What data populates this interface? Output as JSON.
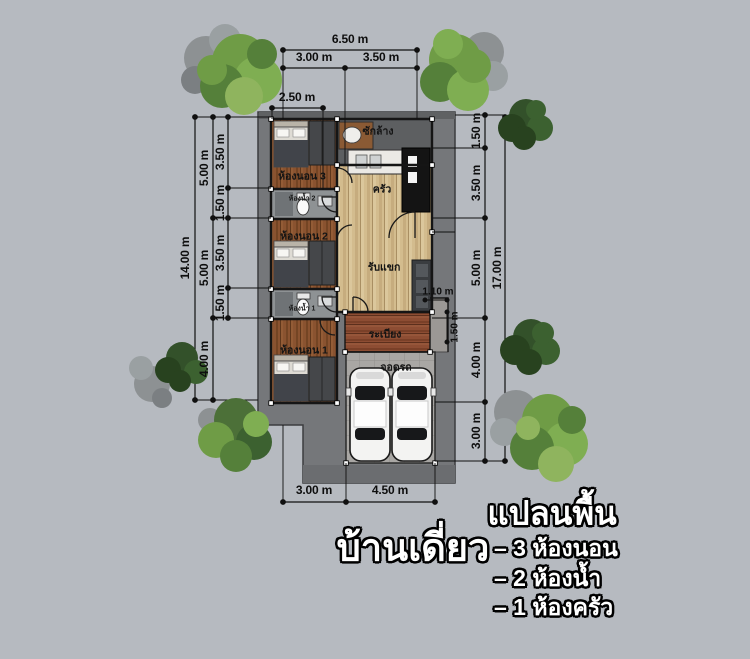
{
  "titles": {
    "plan_name": "บ้านเดี่ยว",
    "legend_heading": "แปลนพื้น",
    "legend_items": [
      "– 3 ห้องนอน",
      "– 2 ห้องน้ำ",
      "– 1 ห้องครัว"
    ]
  },
  "rooms": {
    "laundry": "ซักล้าง",
    "kitchen": "ครัว",
    "bedroom3": "ห้องนอน 3",
    "bath2": "ห้องน้ำ 2",
    "bedroom2": "ห้องนอน 2",
    "living": "รับแขก",
    "bath1": "ห้องน้ำ 1",
    "bedroom1": "ห้องนอน 1",
    "terrace": "ระเบียง",
    "carport": "จอดรถ"
  },
  "dimensions": {
    "top": {
      "total": "6.50 m",
      "left": "3.00 m",
      "right": "3.50 m",
      "inset": "2.50 m"
    },
    "left": {
      "total": "14.00 m",
      "mid": [
        "5.00 m",
        "5.00 m",
        "4.00 m"
      ],
      "inner": [
        "3.50 m",
        "1.50 m",
        "3.50 m",
        "1.50 m"
      ]
    },
    "right": {
      "total": "17.00 m",
      "inner": [
        "1.50 m",
        "3.50 m",
        "5.00 m",
        "4.00 m",
        "3.00 m"
      ]
    },
    "bottom": [
      "3.00 m",
      "4.50 m"
    ],
    "detail": {
      "terrace_width": "1.10 m",
      "terrace_depth": "1.50 m"
    }
  },
  "colors": {
    "background": "#b6bac0",
    "deck": "#75777a",
    "wood_dark": "#8a5330",
    "wood_light": "#d3bc8e",
    "terrace": "#8d4d33",
    "laundry_floor": "#5d5f61",
    "carport_tiles": "#a9a7a4",
    "tree_green": "#6f9c46",
    "tree_dark": "#33512a",
    "line": "#101010"
  }
}
